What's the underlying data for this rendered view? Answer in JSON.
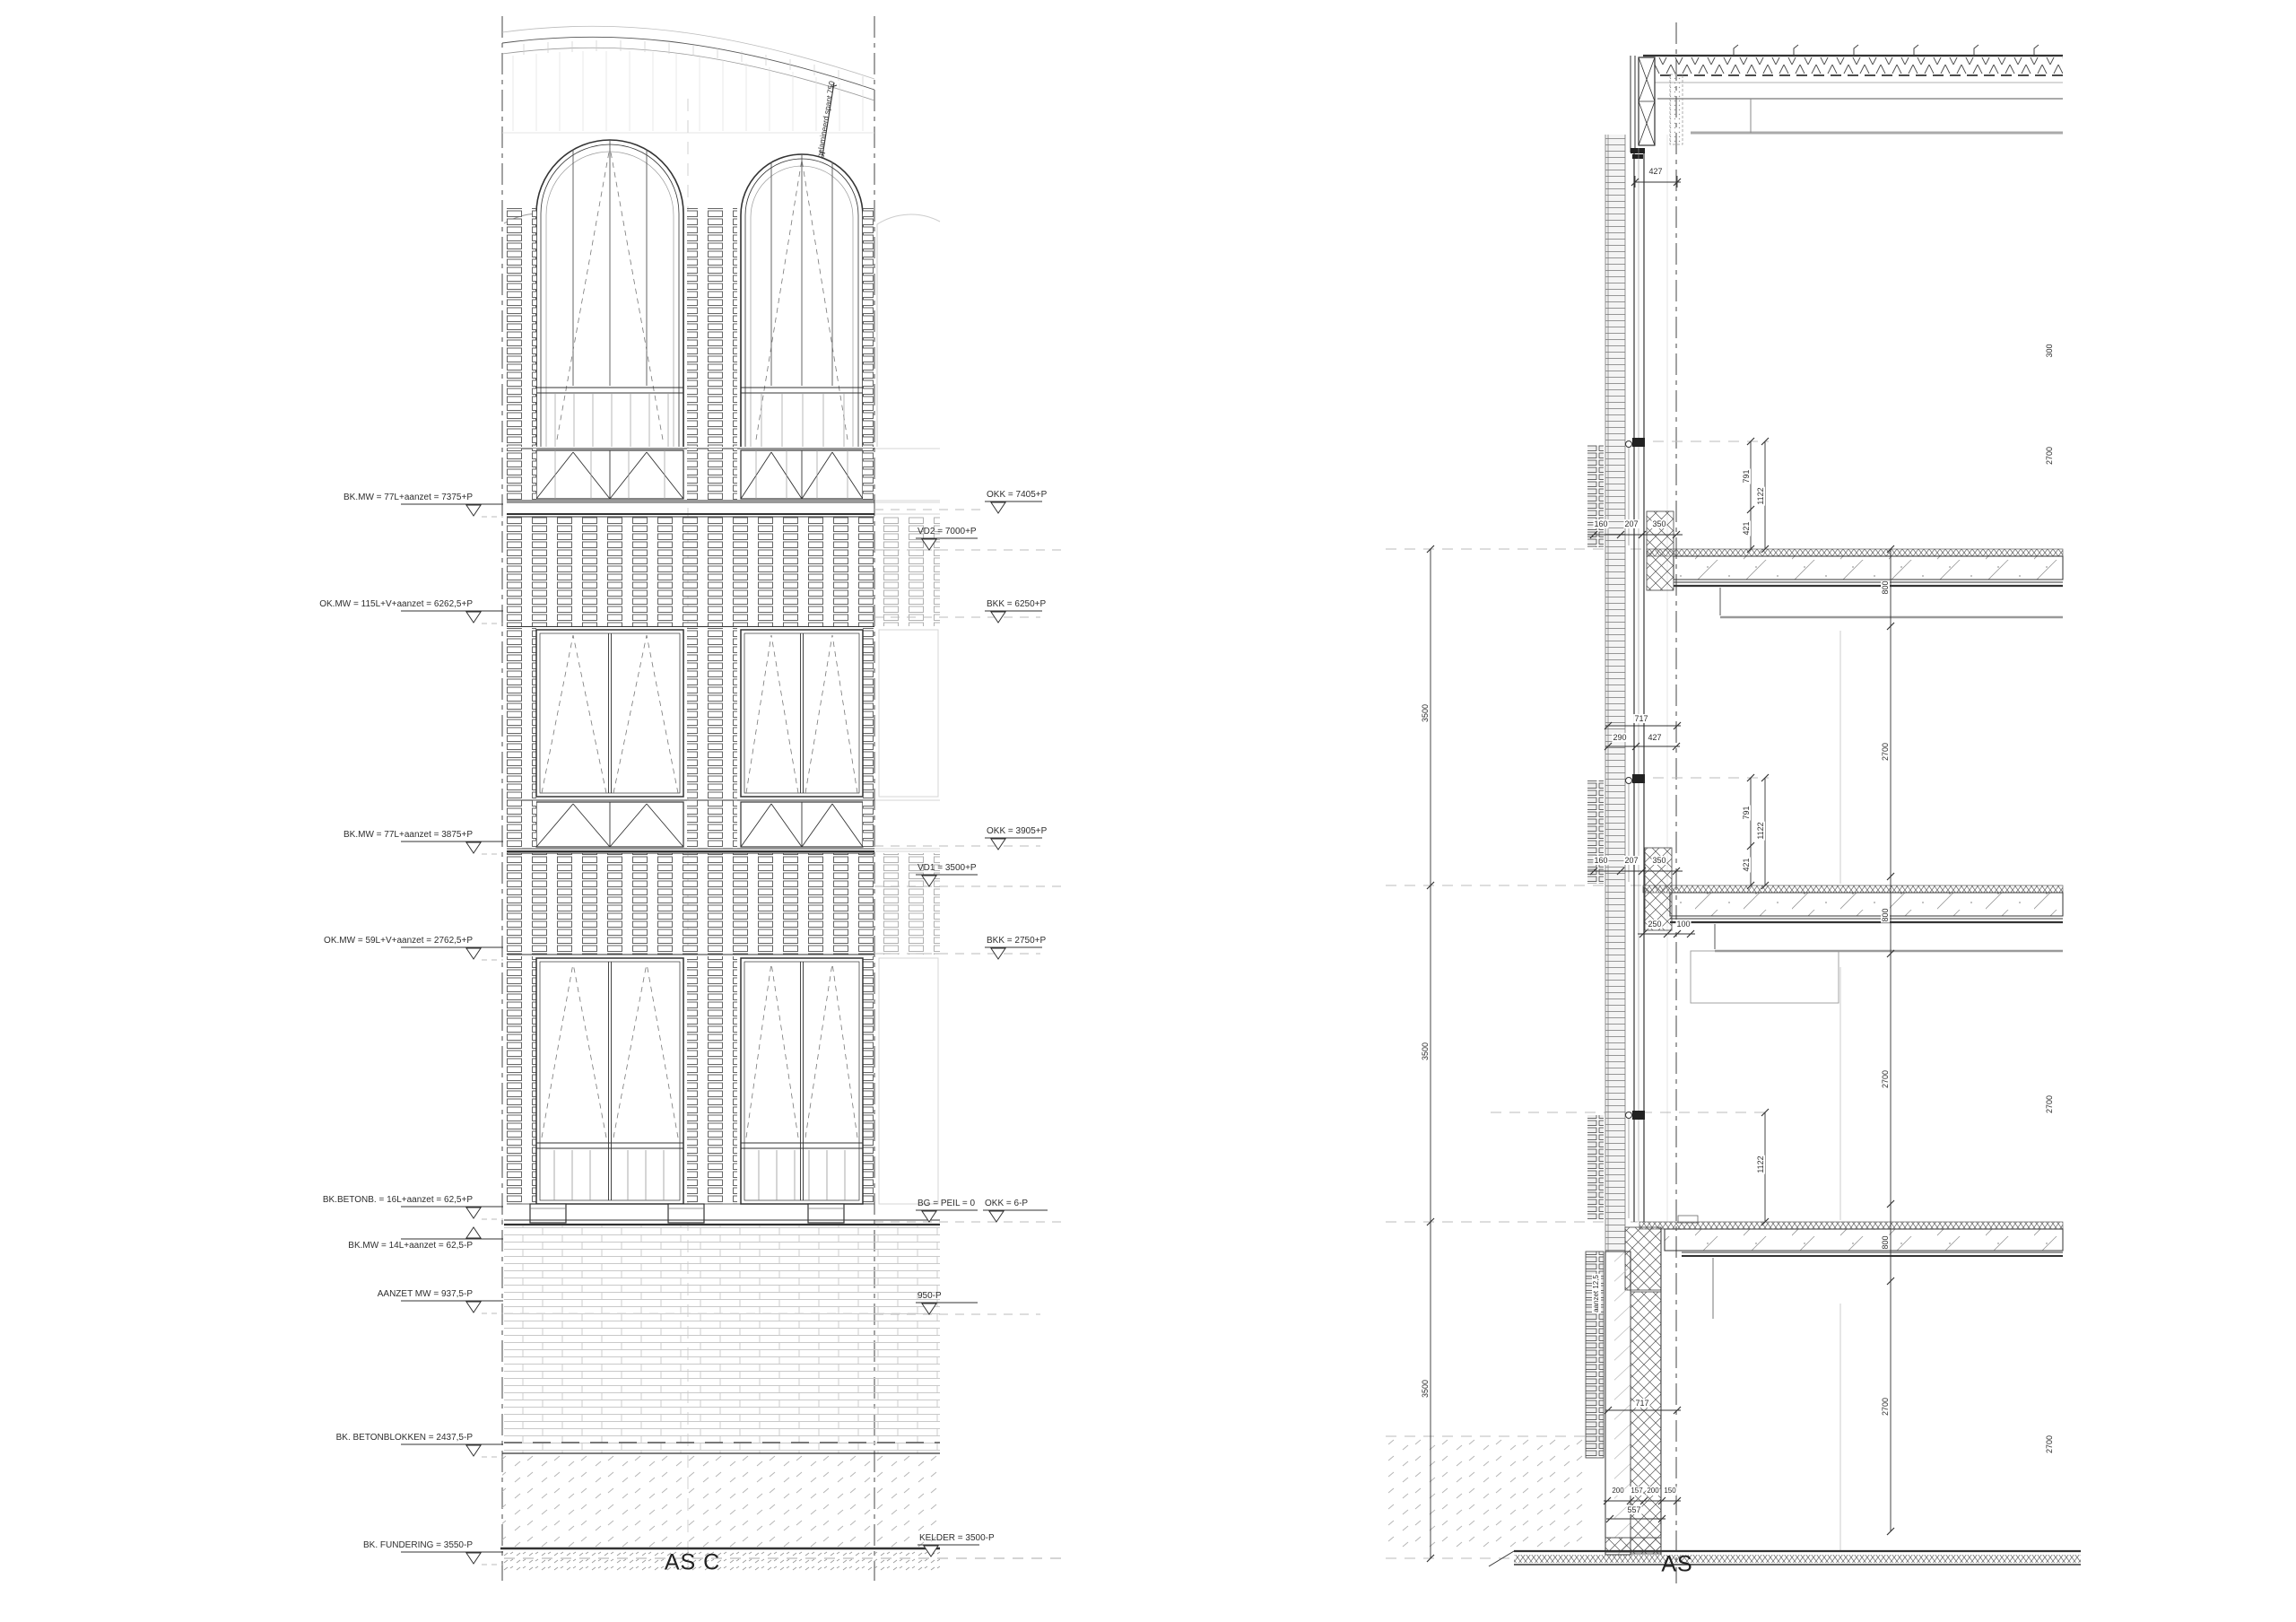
{
  "elev": {
    "axis": "AS C",
    "note": "gelamineerd spant 750",
    "l1": "BK.MW = 77L+aanzet = 7375+P",
    "l2": "OK.MW = 115L+V+aanzet = 6262,5+P",
    "l3": "BK.MW = 77L+aanzet = 3875+P",
    "l4": "OK.MW = 59L+V+aanzet = 2762,5+P",
    "l5": "BK.BETONB. = 16L+aanzet = 62,5+P",
    "l6": "BK.MW = 14L+aanzet = 62,5-P",
    "l7": "AANZET MW = 937,5-P",
    "l8": "BK. BETONBLOKKEN = 2437,5-P",
    "l9": "BK. FUNDERING = 3550-P",
    "r1": "OKK = 7405+P",
    "r2": "VD2 = 7000+P",
    "r3": "BKK = 6250+P",
    "r4": "OKK = 3905+P",
    "r5": "VD1 = 3500+P",
    "r6": "BKK = 2750+P",
    "r7": "BG = PEIL = 0",
    "r8": "OKK = 6-P",
    "r9": "950-P",
    "r10": "KELDER = 3500-P"
  },
  "sec": {
    "axis": "AS",
    "d427a": "427",
    "c160a": "160",
    "c207a": "207",
    "c350a": "350",
    "v791a": "791",
    "v1122a": "1122",
    "v421a": "421",
    "d717a": "717",
    "d290": "290",
    "d427b": "427",
    "v791b": "791",
    "v1122b": "1122",
    "v421b": "421",
    "c160b": "160",
    "c207b": "207",
    "c350b": "350",
    "d250": "250",
    "d100": "100",
    "v1122c": "1122",
    "d717b": "717",
    "d200a": "200",
    "d157": "157",
    "d200b": "200",
    "d150": "150",
    "d557": "557",
    "aanzet": "aanzet 12,5",
    "f3500a": "3500",
    "f3500b": "3500",
    "f3500c": "3500",
    "z800a": "800",
    "z2700a": "2700",
    "z800b": "800",
    "z2700b": "2700",
    "z800c": "800",
    "z2700c": "2700",
    "e300": "300",
    "e2700a": "2700",
    "e2700b": "2700",
    "e2700c": "2700"
  }
}
